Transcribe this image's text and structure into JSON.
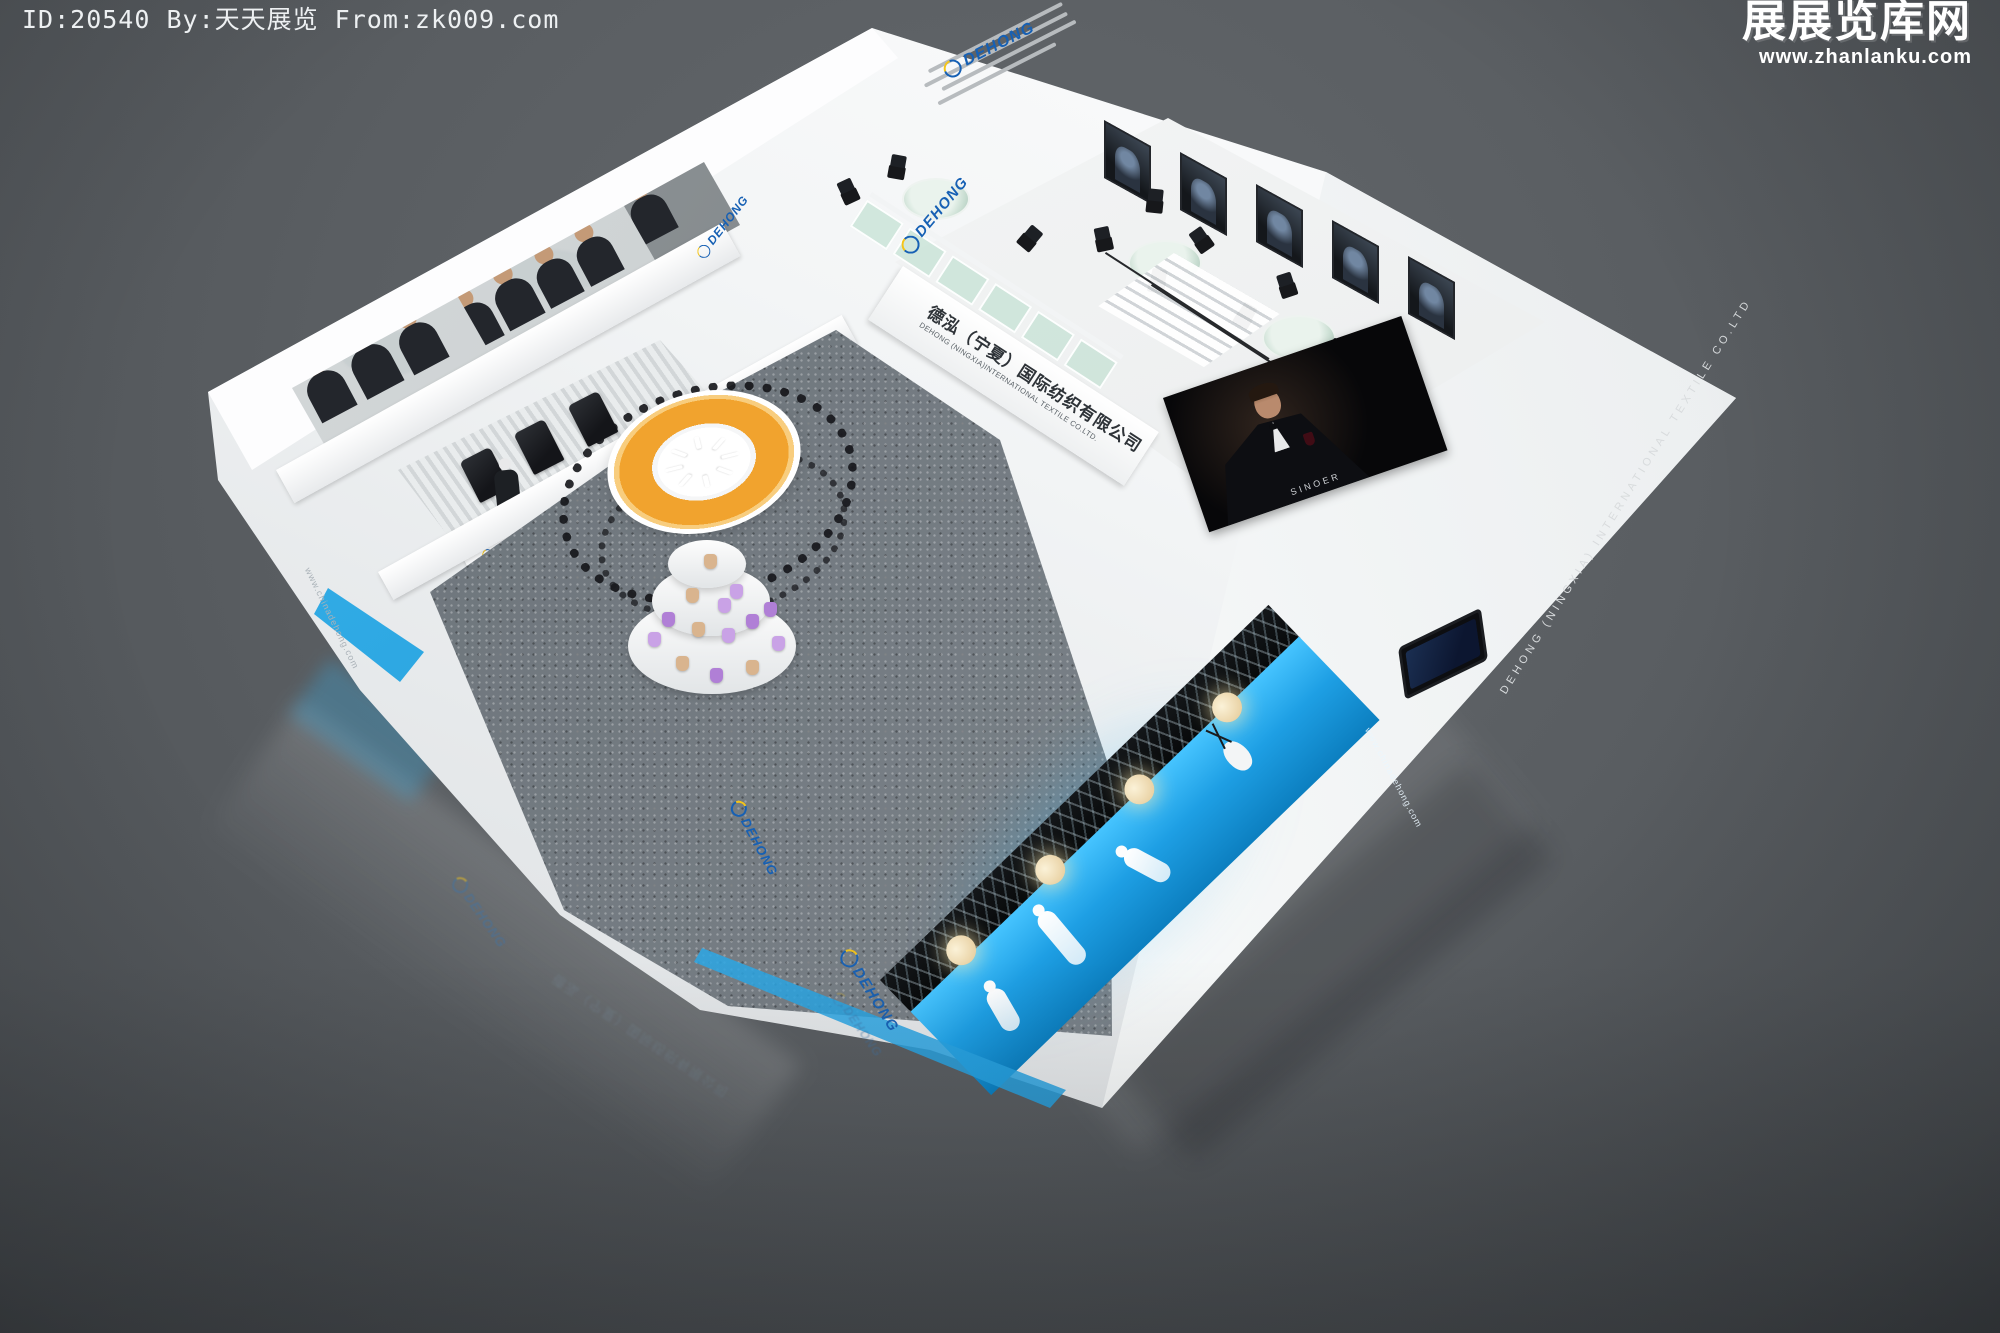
{
  "watermark": {
    "id_line": "ID:20540 By:天天展览 From:zk009.com",
    "site_logo": "展展览库网",
    "site_url": "www.zhanlanku.com"
  },
  "booth": {
    "brand": "DEHONG",
    "sign_cn": "德泓（宁夏）国际纺织有限公司",
    "sign_en": "DEHONG (NINGXIA)INTERNATIONAL TEXTILE CO.LTD.",
    "screen_caption": "SINOER",
    "website": "www.chinadehong.com",
    "wall_text": "DEHONG (NINGXIA) INTERNATIONAL TEXTILE CO.LTD"
  },
  "colors": {
    "background": "#5a5e62",
    "booth_white": "#f4f5f6",
    "brand_blue": "#1660b4",
    "brand_yellow": "#f5c518",
    "platform_cyan": "#22a7ef",
    "ring_orange": "#f1a32e",
    "carpet_gray": "#7d858c",
    "glass_green": "#c4e0d2"
  },
  "icons": {
    "dehong_swoosh": "blue ring swoosh with yellow accent",
    "pendant_lamp": "glowing cream sphere",
    "yarn_cone": "small yarn cone",
    "mannequin": "white abstract figure"
  }
}
